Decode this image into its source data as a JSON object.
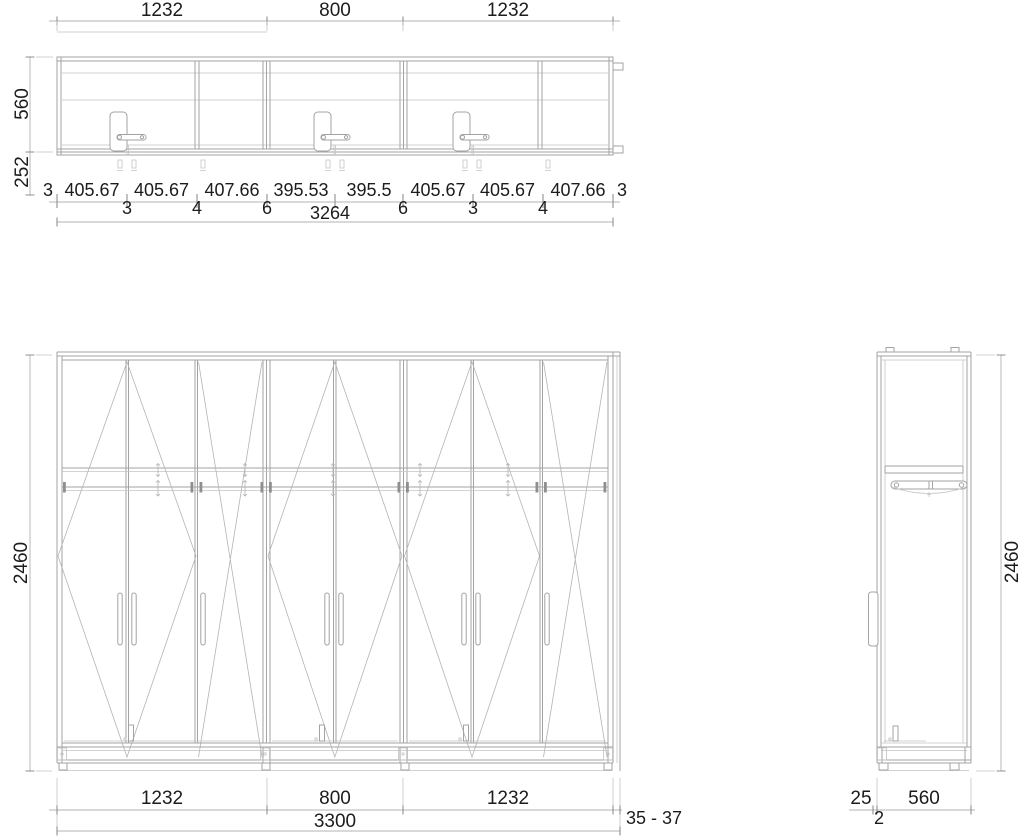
{
  "plan": {
    "width_dims": [
      "1232",
      "800",
      "1232"
    ],
    "depth_dim": "560",
    "front_dim": "252",
    "segment_dims": [
      "3",
      "405.67",
      "405.67",
      "407.66",
      "395.53",
      "395.5",
      "405.67",
      "405.67",
      "407.66",
      "3"
    ],
    "gap_dims": [
      "3",
      "4",
      "6",
      "6",
      "3",
      "4"
    ],
    "total_width_dim": "3264"
  },
  "front": {
    "height_dim": "2460",
    "width_dims": [
      "1232",
      "800",
      "1232"
    ],
    "total_width_dim": "3300",
    "side_gap_dim": "35 - 37"
  },
  "side": {
    "height_dim": "2460",
    "bottom_dims": [
      "25",
      "2",
      "560"
    ]
  }
}
